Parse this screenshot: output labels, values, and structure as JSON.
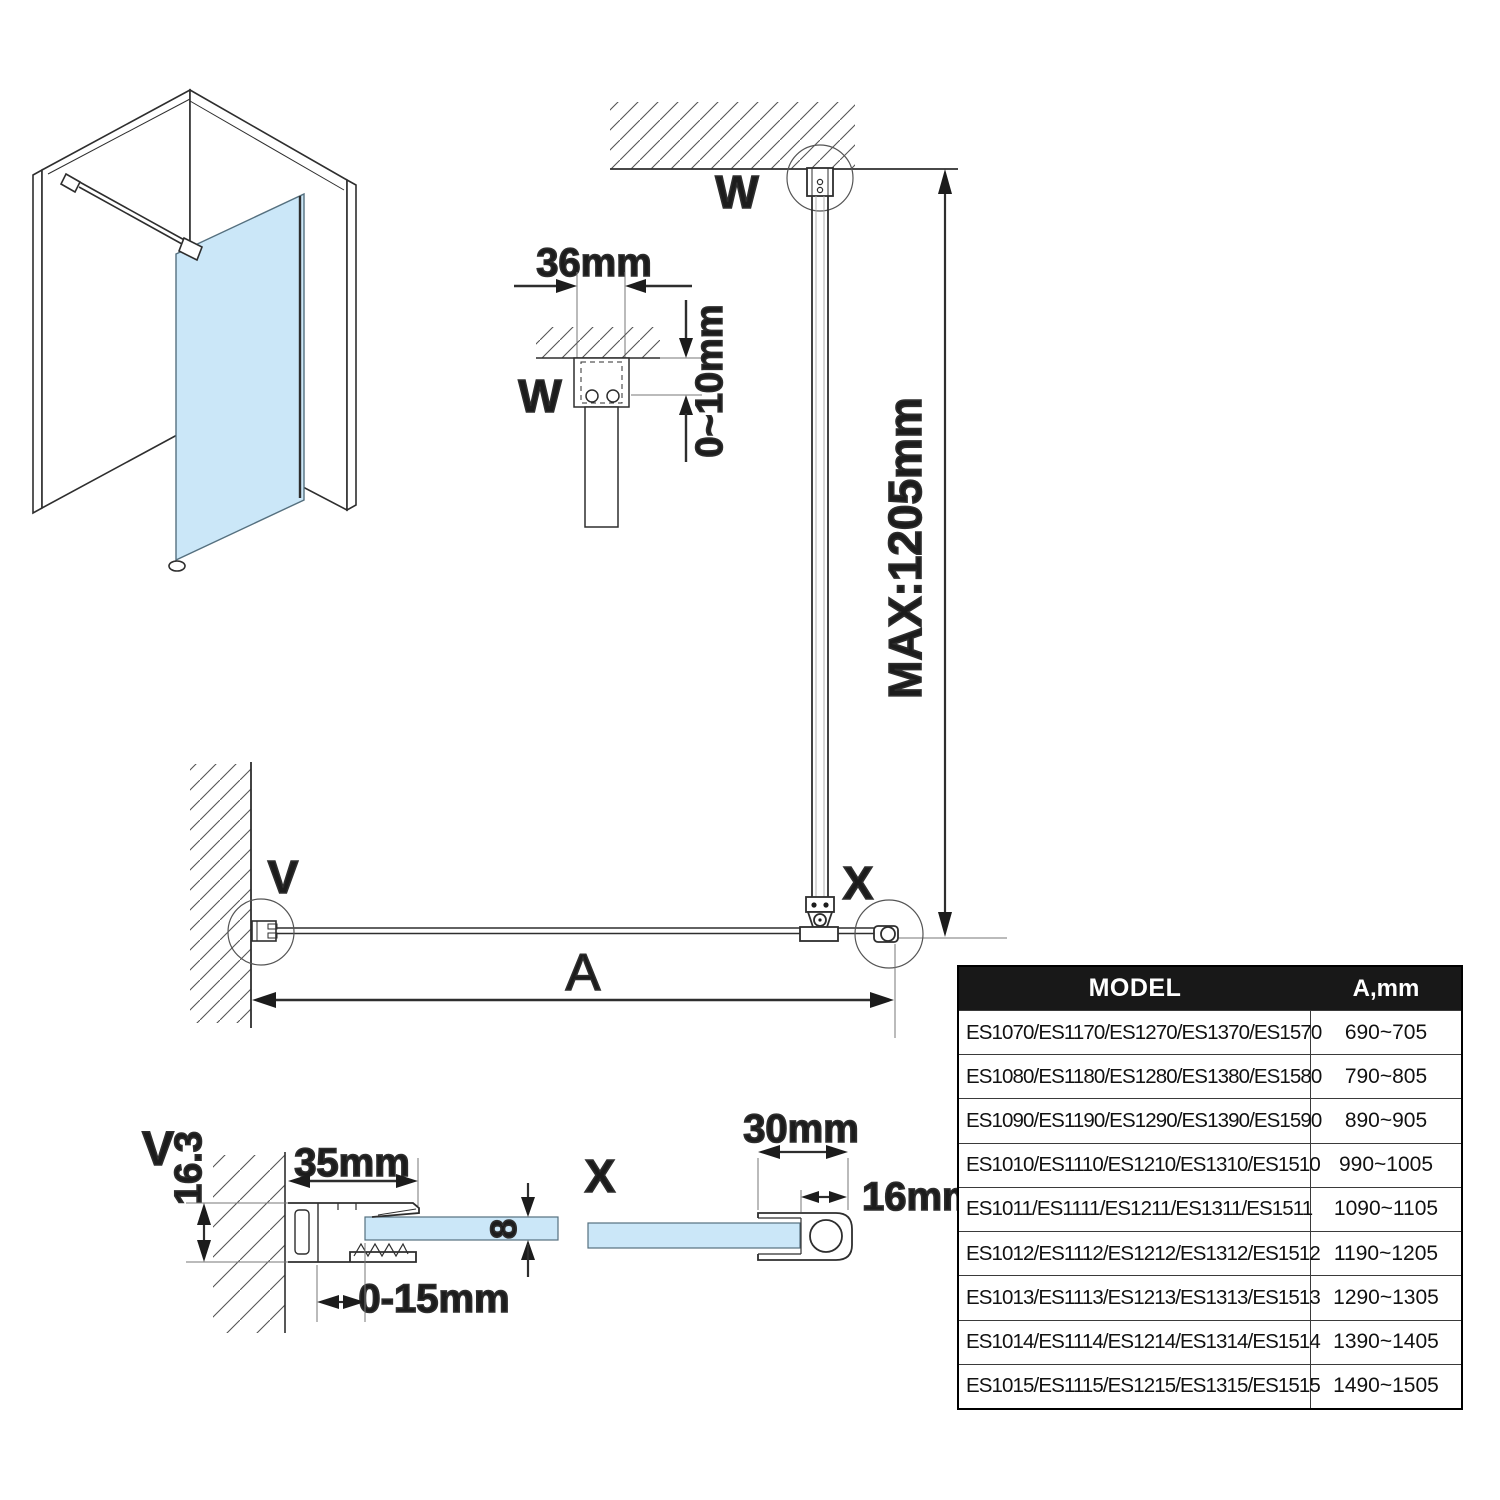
{
  "labels": {
    "w_elevation": "W",
    "w_detail": "W",
    "v_plan": "V",
    "x_plan": "X",
    "v_detail": "V",
    "x_detail": "X"
  },
  "dims": {
    "bracket_width": "36mm",
    "ceiling_gap": "0~10mm",
    "max_height": "MAX:1205mm",
    "span": "A",
    "wall_profile_width": "35mm",
    "wall_profile_depth": "16.3",
    "glass_thickness": "8",
    "adjustment": "0-15mm",
    "end_profile_width": "30mm",
    "end_tube_width": "16mm"
  },
  "table": {
    "headers": {
      "model": "MODEL",
      "a": "A,mm"
    },
    "rows": [
      {
        "model": "ES1070/ES1170/ES1270/ES1370/ES1570",
        "a": "690~705"
      },
      {
        "model": "ES1080/ES1180/ES1280/ES1380/ES1580",
        "a": "790~805"
      },
      {
        "model": "ES1090/ES1190/ES1290/ES1390/ES1590",
        "a": "890~905"
      },
      {
        "model": "ES1010/ES1110/ES1210/ES1310/ES1510",
        "a": "990~1005"
      },
      {
        "model": "ES1011/ES1111/ES1211/ES1311/ES1511",
        "a": "1090~1105"
      },
      {
        "model": "ES1012/ES1112/ES1212/ES1312/ES1512",
        "a": "1190~1205"
      },
      {
        "model": "ES1013/ES1113/ES1213/ES1313/ES1513",
        "a": "1290~1305"
      },
      {
        "model": "ES1014/ES1114/ES1214/ES1314/ES1514",
        "a": "1390~1405"
      },
      {
        "model": "ES1015/ES1115/ES1215/ES1315/ES1515",
        "a": "1490~1505"
      }
    ]
  },
  "colors": {
    "glass": "#cbe7f8",
    "line": "#2e2e2e",
    "header_bg": "#181818",
    "header_text": "#ffffff"
  }
}
